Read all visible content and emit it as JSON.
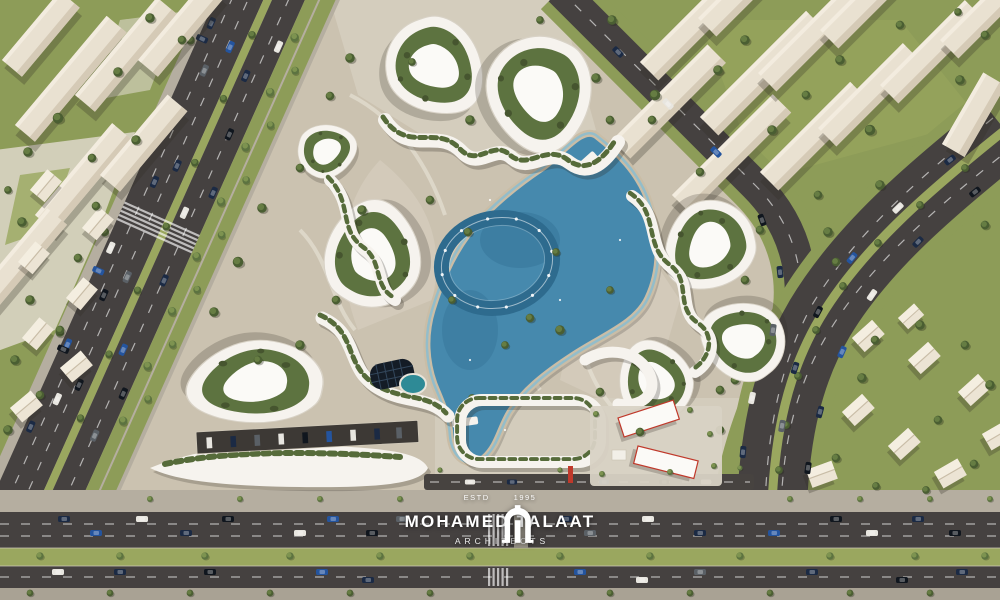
{
  "brand": {
    "established_label": "ESTD",
    "established_year": "1995",
    "name": "MOHAMED TALAAT",
    "subtitle": "ARCHITECTS",
    "logo_icon": "arch-gate-icon"
  },
  "palette": {
    "ground": "#cbc2b0",
    "plaza": "#ded8ca",
    "sidewalk": "#b5aea0",
    "grass": "#8d9c58",
    "grass_bright": "#9aa75f",
    "tree_dark": "#4a5e32",
    "tree_mid": "#667d43",
    "asphalt": "#454140",
    "asphalt_dark": "#3a3631",
    "lane_line": "#ffffff",
    "building_cream": "#e9e1d1",
    "building_white": "#f6f3ee",
    "lake": "#4689ad",
    "lake_deep": "#2e6b8e",
    "lake_shore": "#85bdd3",
    "pond_teal": "#2e8a96",
    "solar_dark": "#141c26",
    "accent_red": "#c0392b",
    "car_navy": "#1b2a44",
    "car_black": "#10161e",
    "car_white": "#e8e6e0",
    "car_gray": "#5a6066",
    "car_blue": "#24549e"
  }
}
